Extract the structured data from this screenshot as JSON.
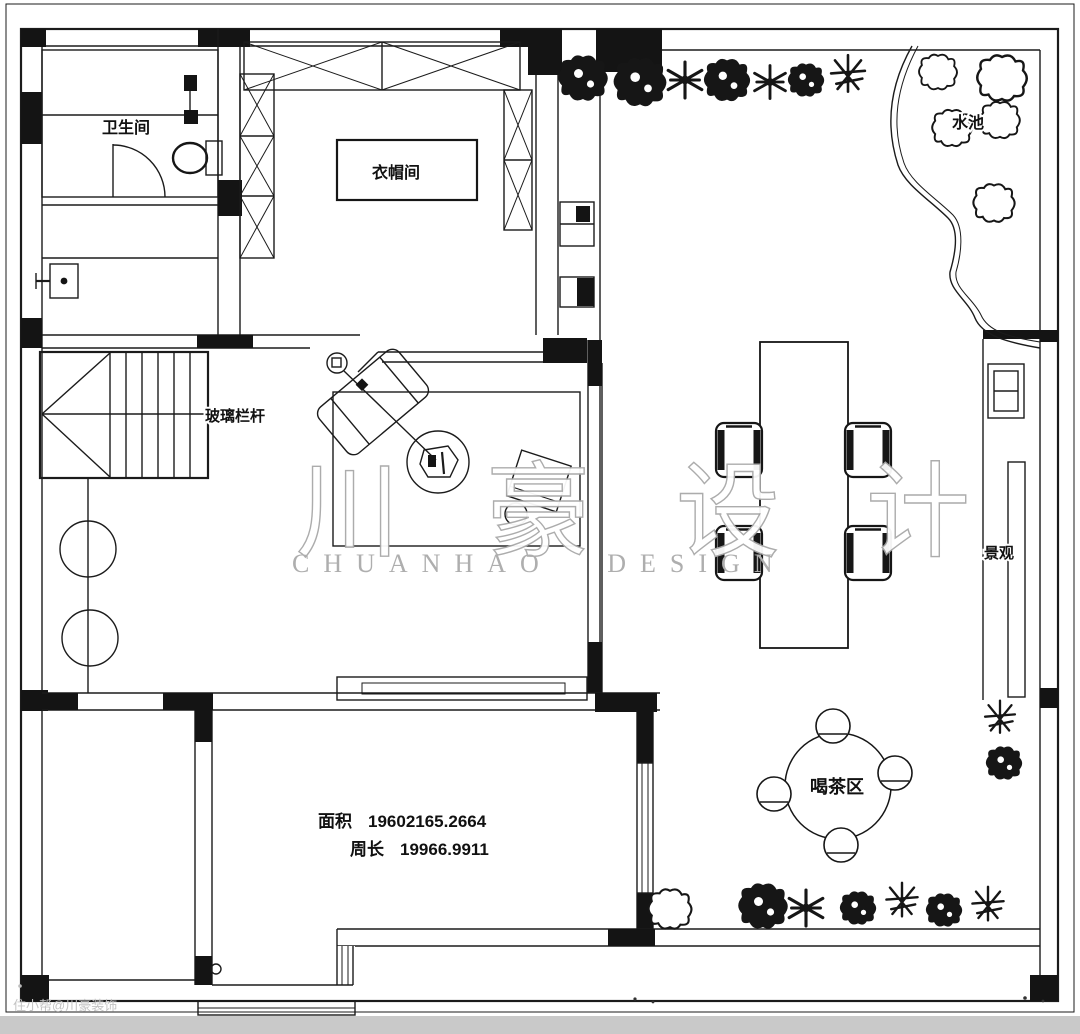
{
  "labels": {
    "bathroom": "卫生间",
    "cloakroom": "衣帽间",
    "railing": "玻璃栏杆",
    "pond": "水池",
    "landscape": "景观",
    "tea_area": "喝茶区"
  },
  "measurements": {
    "area_label": "面积",
    "area_value": "19602165.2664",
    "perimeter_label": "周长",
    "perimeter_value": "19966.9911"
  },
  "watermark": {
    "brand_cn": "川 豪 设 计",
    "brand_en": "CHUANHAO DESIGN",
    "corner": "住小帮@川豪装饰"
  },
  "colors": {
    "ink": "#1b1b1b",
    "watermark_gray": "#b2b2b2",
    "paper": "#ffffff",
    "footer_bar": "#c9c9c9"
  }
}
